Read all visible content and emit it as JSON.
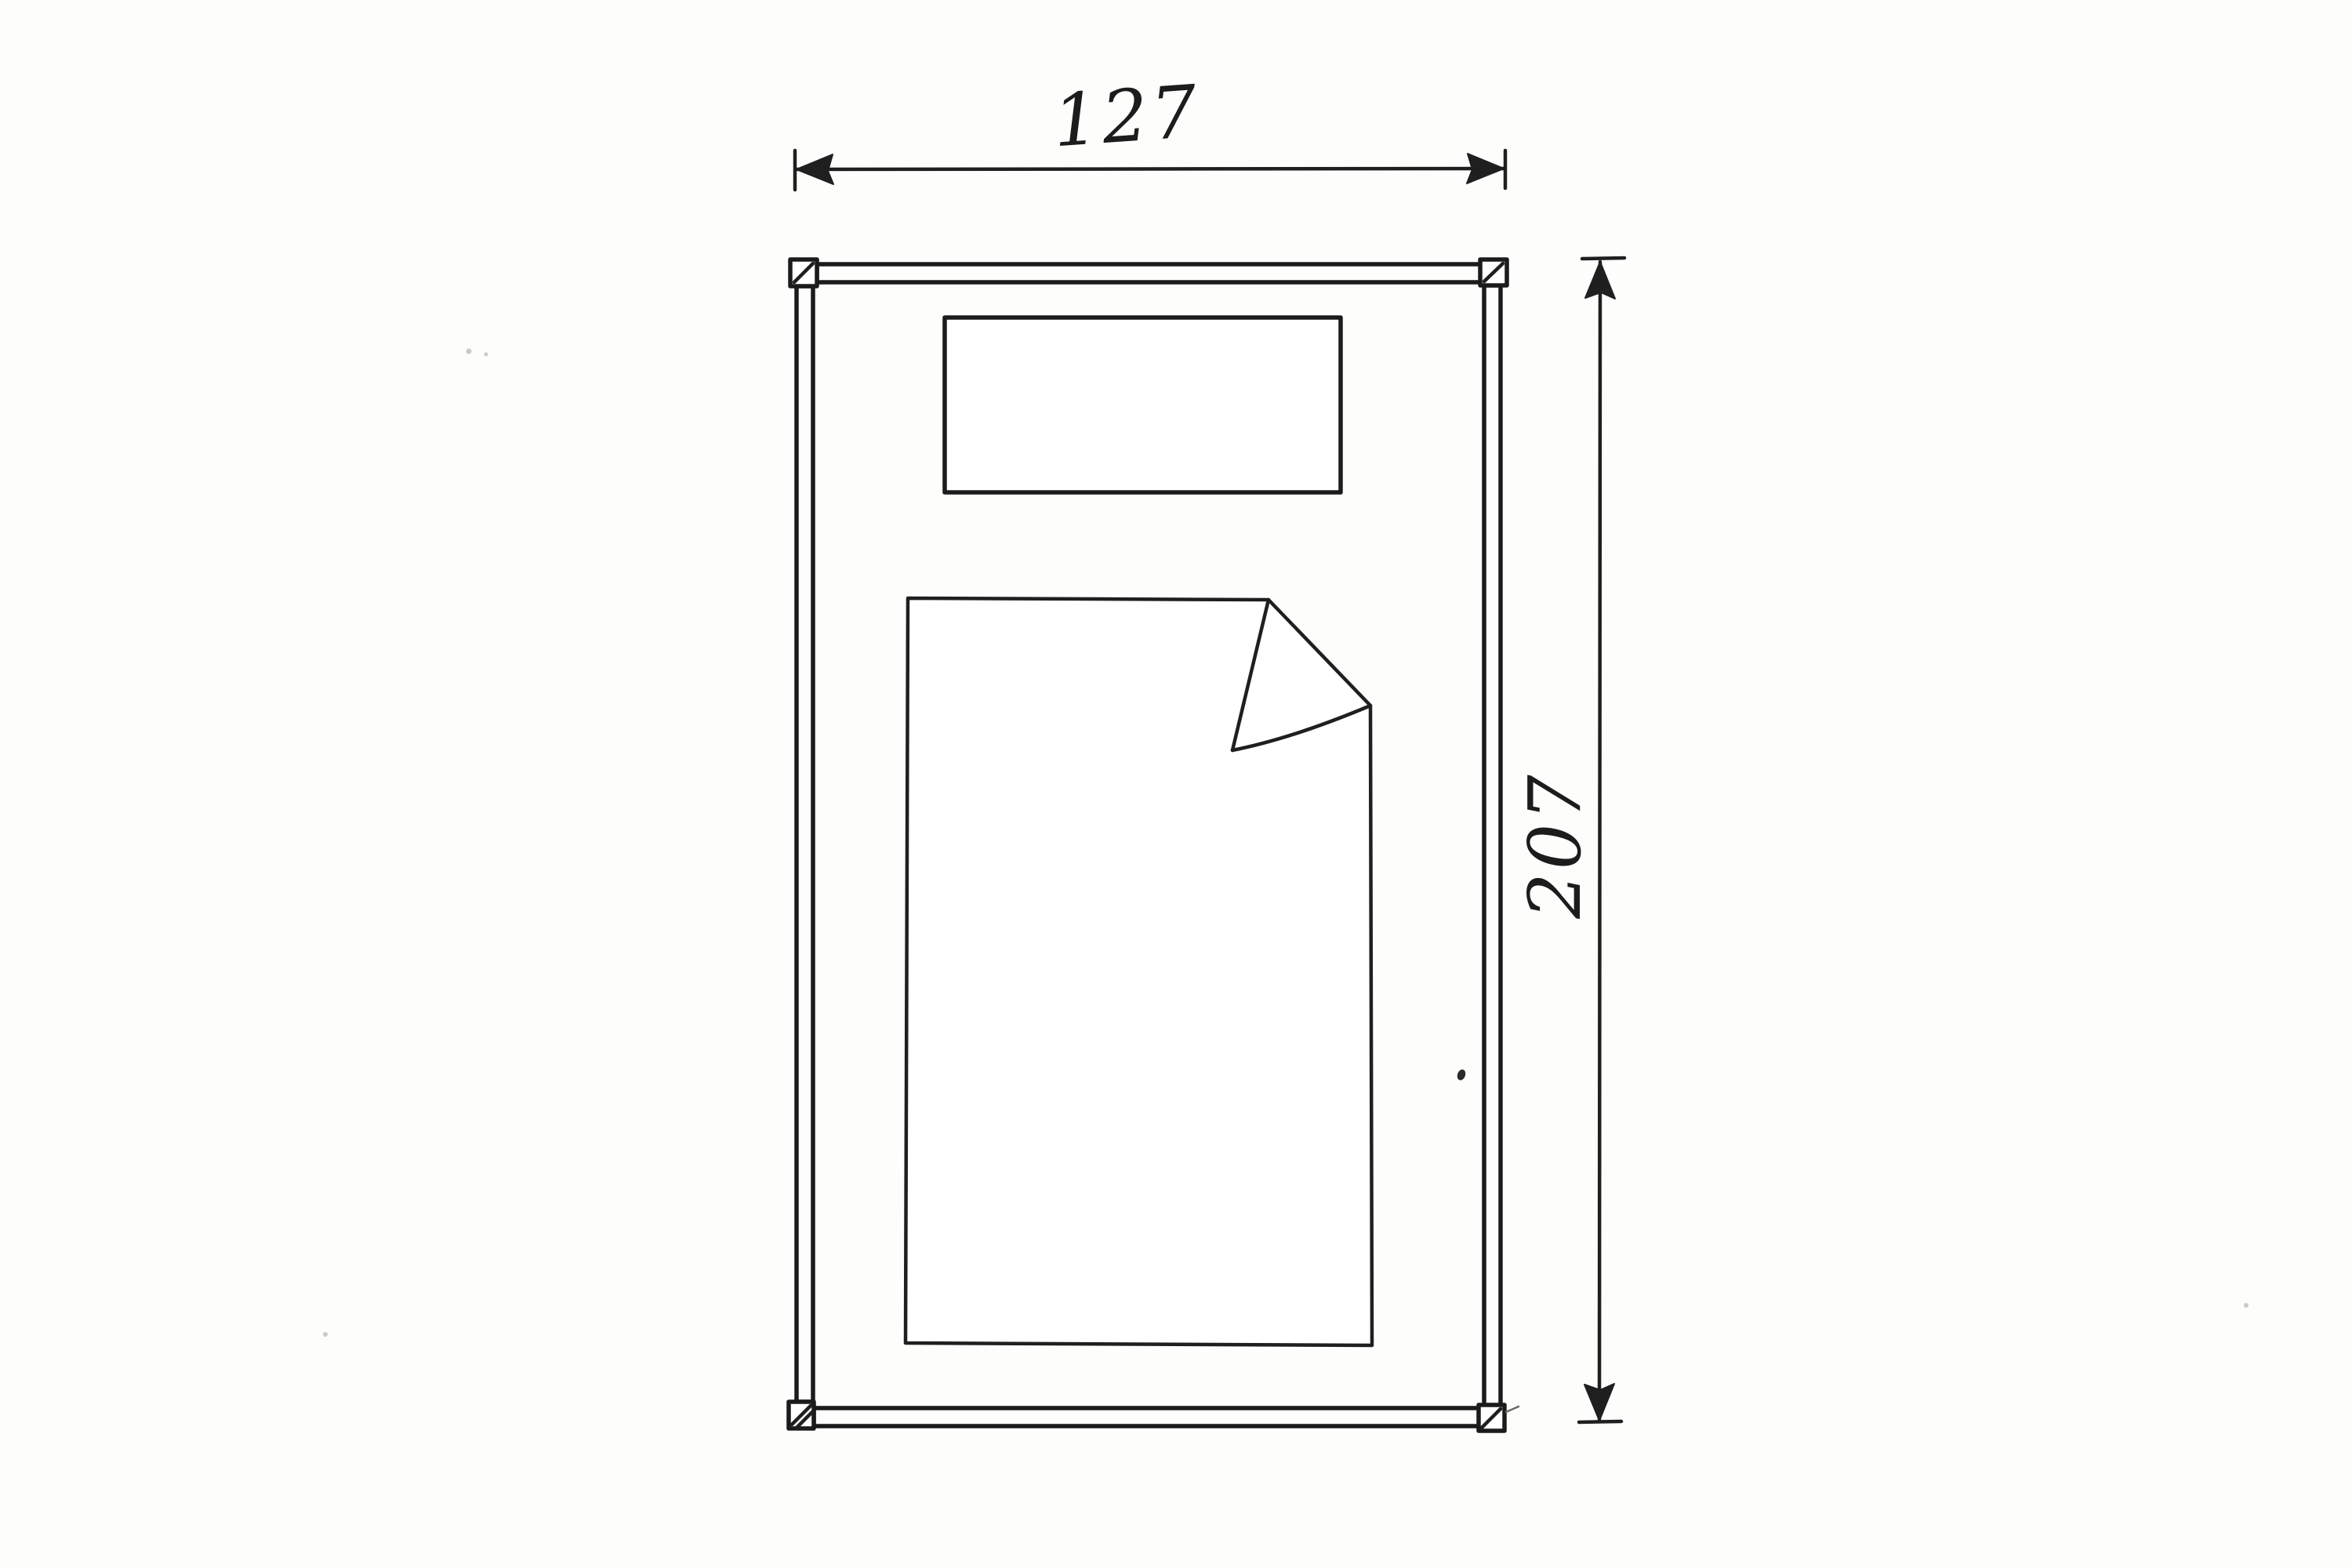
{
  "drawing": {
    "width_dimension": {
      "label": "127"
    },
    "height_dimension": {
      "label": "207"
    },
    "colors": {
      "ink": "#1f1f1f",
      "frame_fill": "#f0e5b0",
      "paper": "#fdfdfc",
      "bedding_fill": "#ffffff"
    }
  }
}
